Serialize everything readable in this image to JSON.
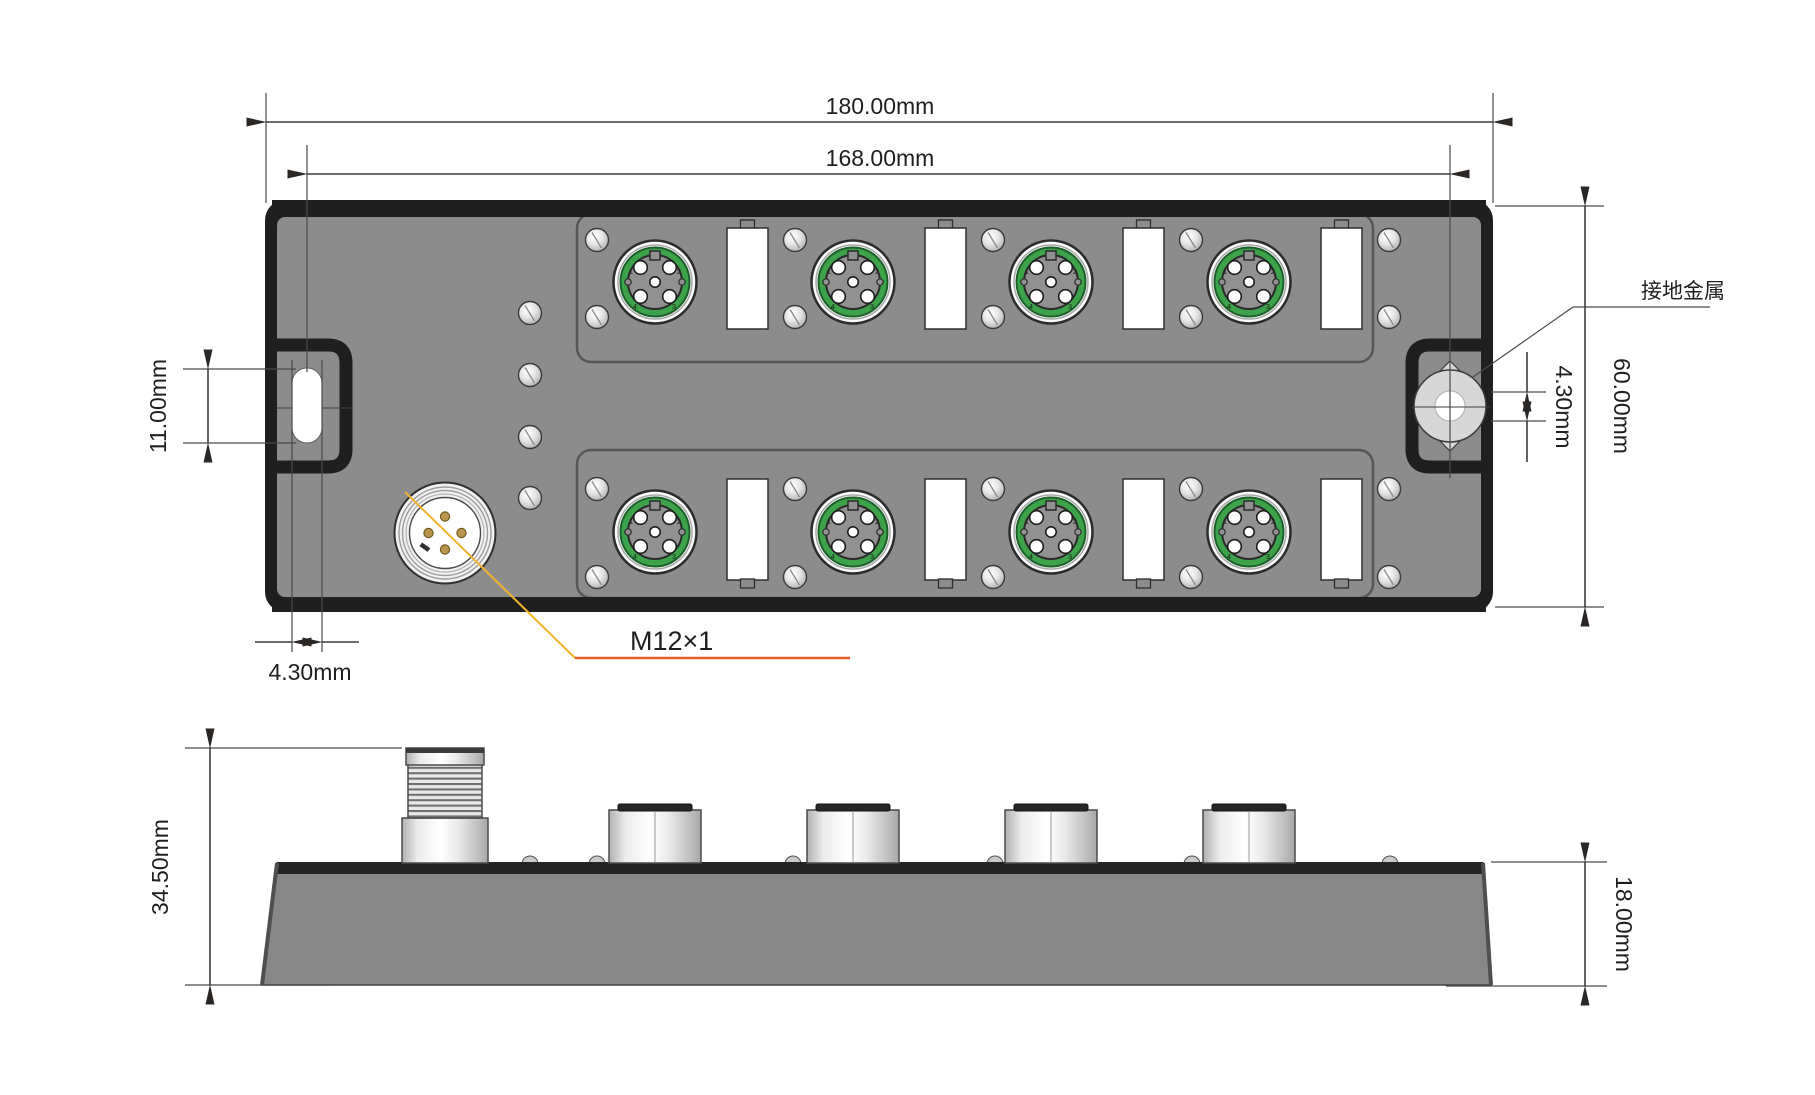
{
  "drawing": {
    "views": [
      "top-view",
      "side-view"
    ]
  },
  "dimensions": {
    "overall_width": "180.00mm",
    "mount_hole_spacing": "168.00mm",
    "slot_length": "11.00mm",
    "slot_width": "4.30mm",
    "ground_hole_diameter": "4.30mm",
    "body_height": "60.00mm",
    "total_height": "34.50mm",
    "base_height": "18.00mm"
  },
  "labels": {
    "ground_metal": "接地金属",
    "thread_spec": "M12×1"
  },
  "port": {
    "pins": [
      "1",
      "2",
      "3",
      "4"
    ]
  },
  "colors": {
    "body_gray": "#8c8c8c",
    "border_dark": "#1f1f1f",
    "port_green": "#3da34a",
    "pin_gold": "#b9964b",
    "metal_light": "#d7d7d7",
    "leader_yellow": "#f2b22e",
    "leader_orange": "#e85c28",
    "dimension_ink": "#3b3b3b",
    "side_body_gray": "#878787"
  }
}
